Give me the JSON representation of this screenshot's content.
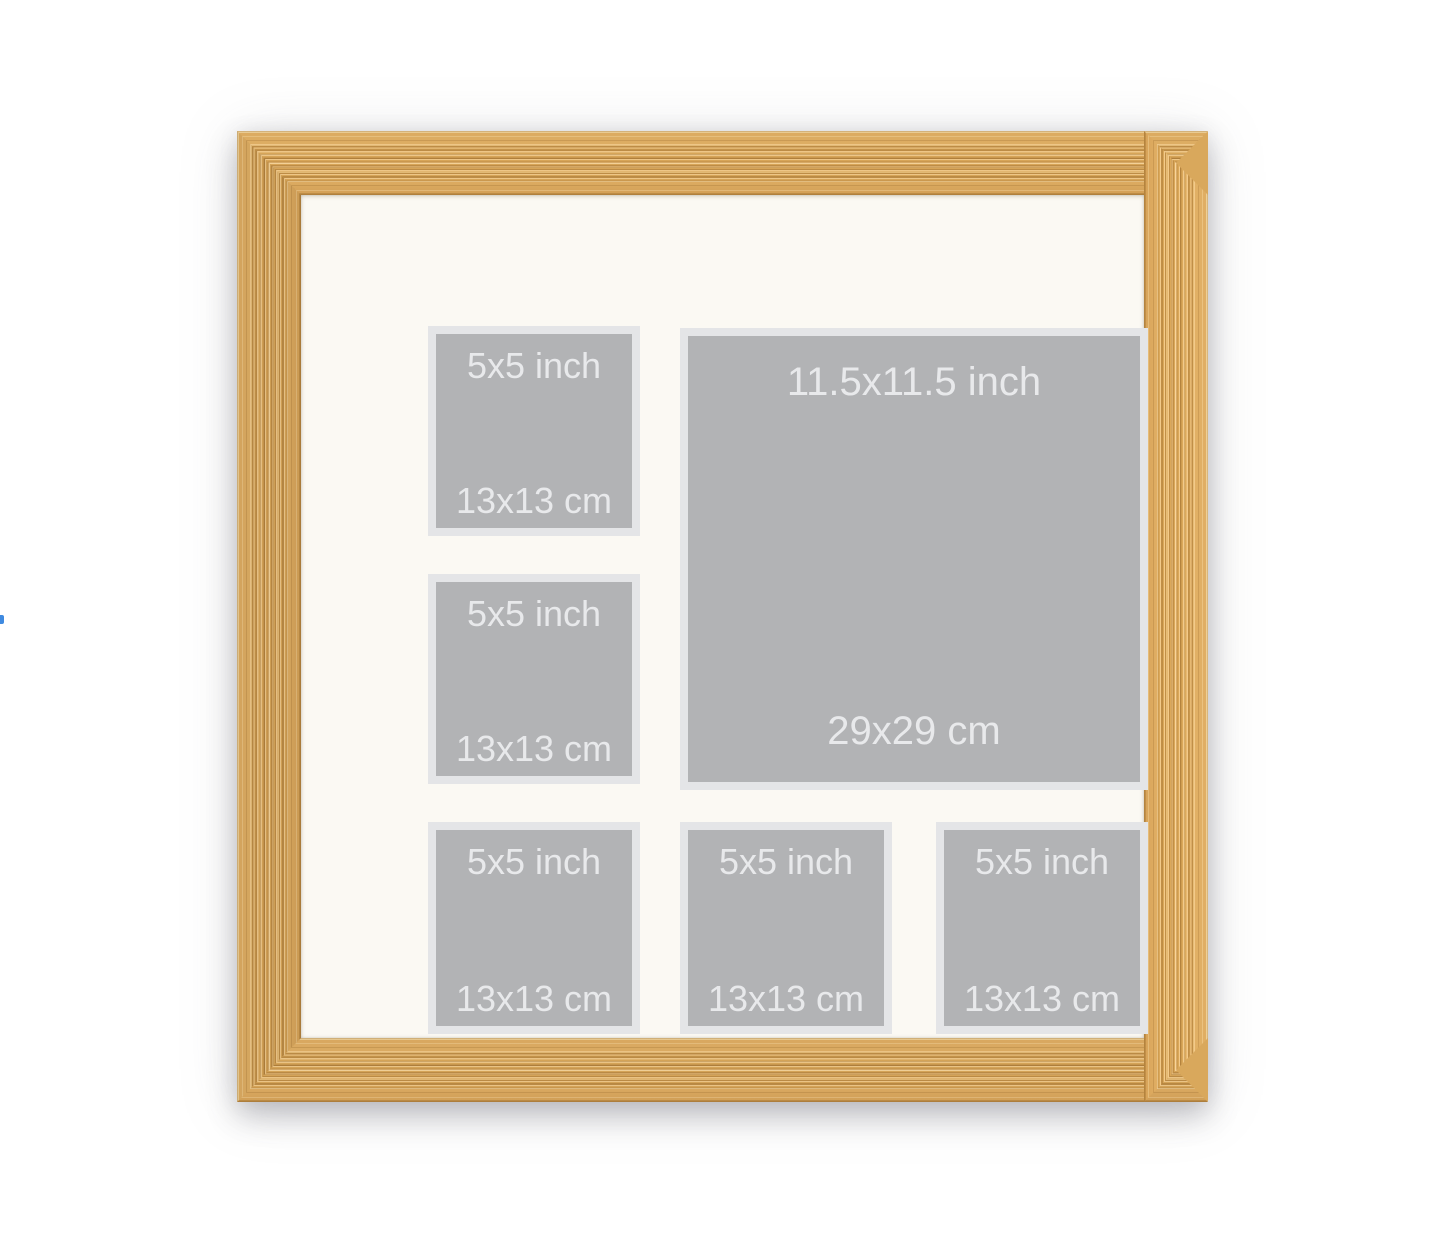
{
  "apertures": {
    "large": {
      "size_inch": "11.5x11.5 inch",
      "size_cm": "29x29 cm"
    },
    "small": {
      "size_inch": "5x5 inch",
      "size_cm": "13x13 cm"
    }
  },
  "colors": {
    "background": "#ffffff",
    "frame_wood": "#d9a85c",
    "frame_ridge_dark": "#bd8c46",
    "frame_ridge_light": "#eec687",
    "frame_edge_highlight": "#e9cb92",
    "mat": "#fbf9f3",
    "aperture_bevel": "#e4e5e7",
    "aperture_placeholder": "#b2b3b5",
    "label_text": "#e8e9eb",
    "cursor_mark": "#3f8ae0"
  }
}
